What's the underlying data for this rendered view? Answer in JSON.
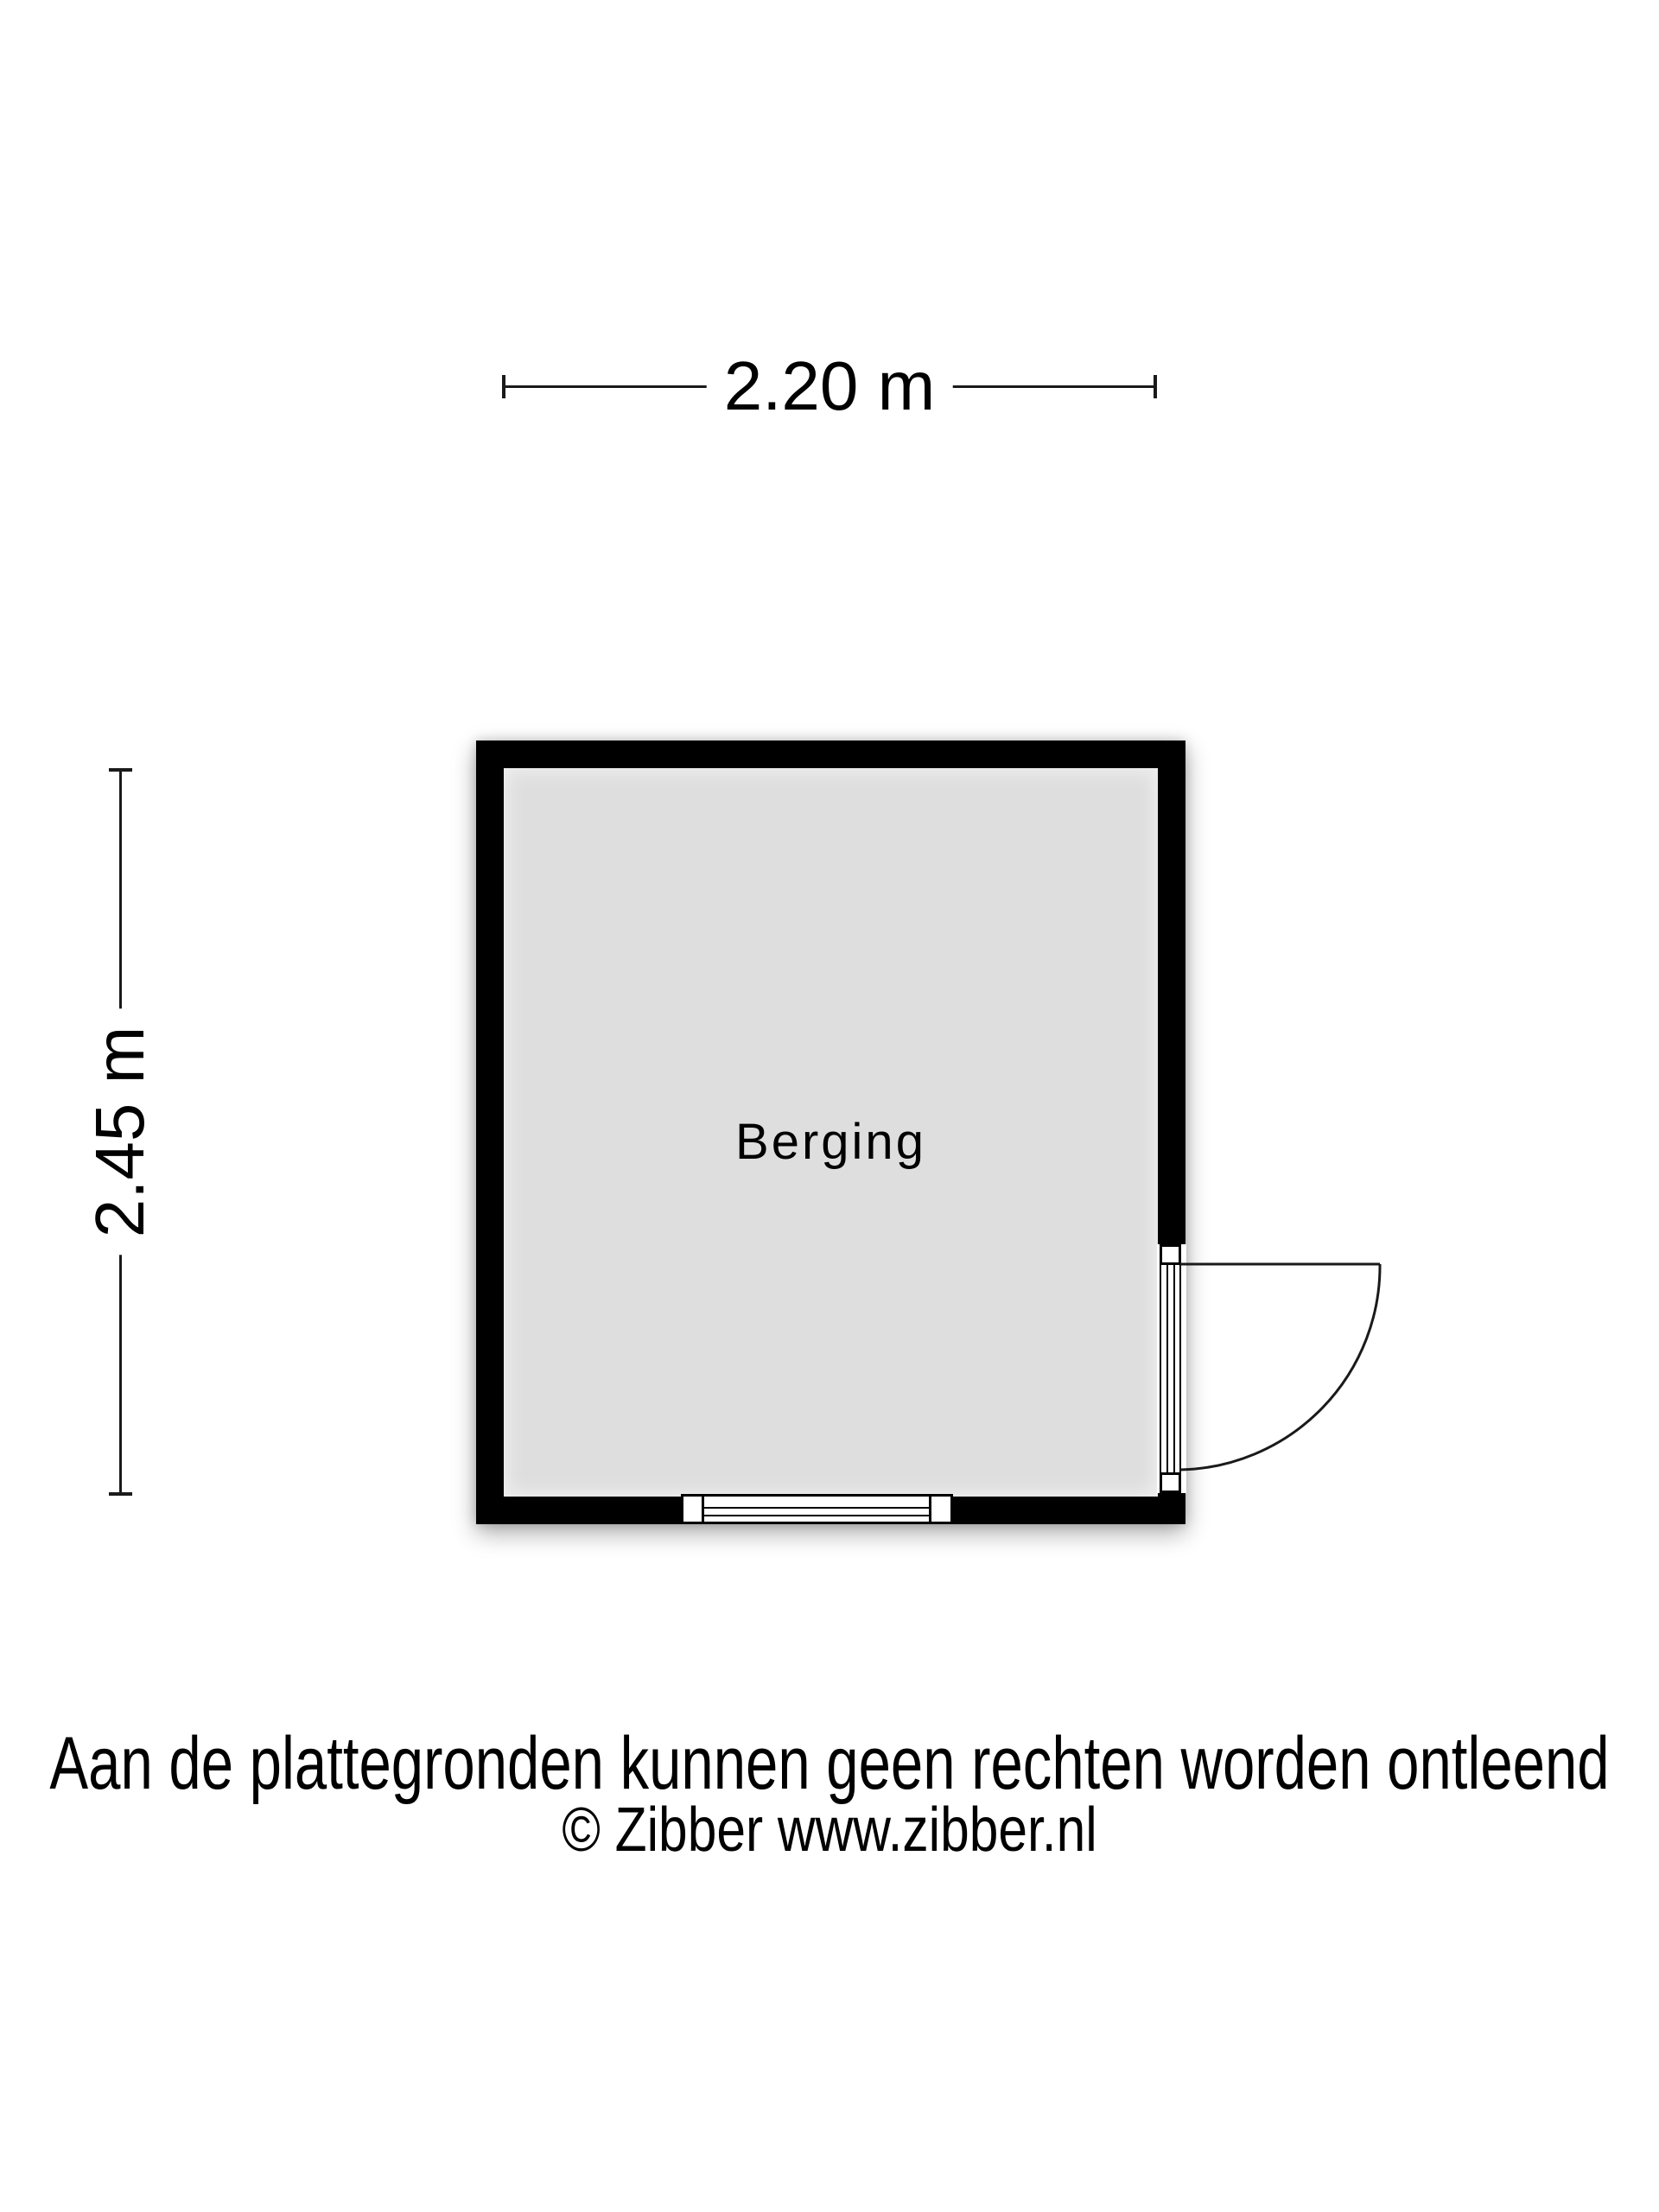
{
  "plan": {
    "room": {
      "label": "Berging"
    },
    "dimensions": {
      "width_label": "2.20 m",
      "height_label": "2.45 m"
    }
  },
  "footer": {
    "disclaimer": "Aan de plattegronden kunnen geen rechten worden ontleend",
    "copyright": "© Zibber www.zibber.nl"
  },
  "colors": {
    "wall": "#000000",
    "floor": "#dedede",
    "line": "#1a1a1a",
    "background": "#ffffff",
    "text": "#000000"
  }
}
